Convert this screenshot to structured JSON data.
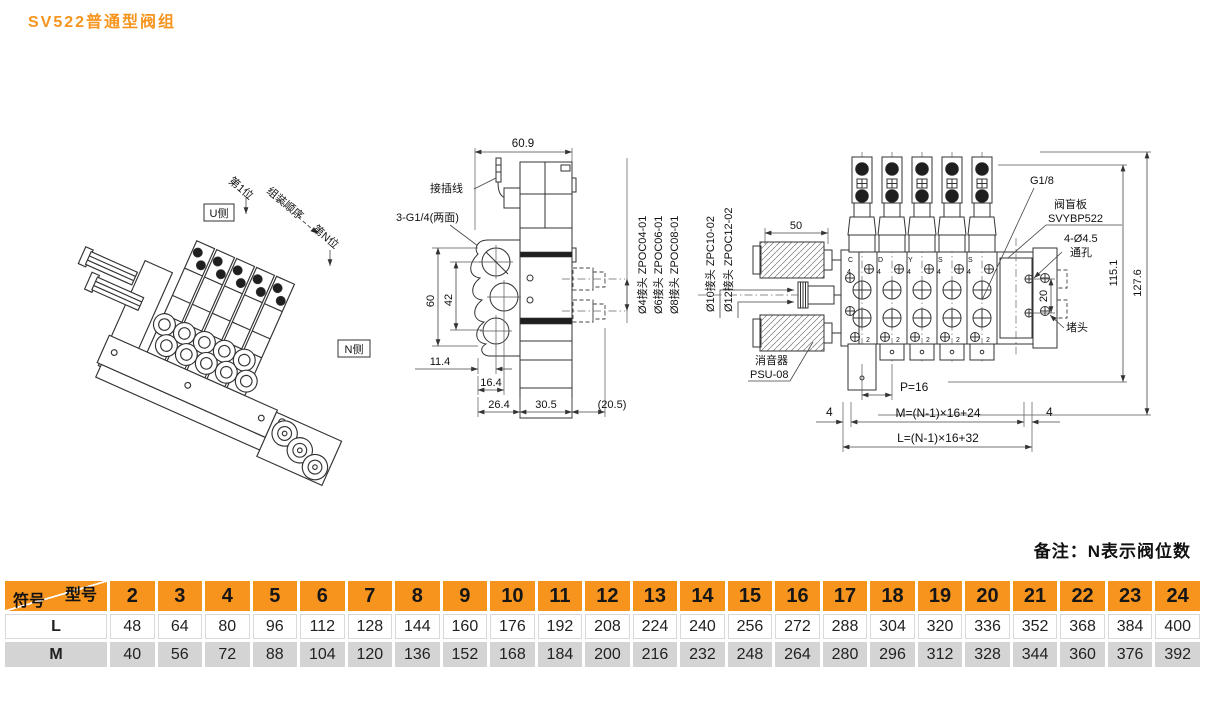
{
  "page": {
    "title": "SV522普通型阀组",
    "note": "备注：N表示阀位数"
  },
  "iso": {
    "pos_first": "第1位",
    "u_side": "U侧",
    "order": "组装顺序",
    "pos_n": "第N位",
    "n_side": "N侧"
  },
  "side": {
    "dim_width": "60.9",
    "wire": "接插线",
    "thread": "3-G1/4(两面)",
    "dim_h1": "60",
    "dim_h2": "42",
    "dim_b1": "11.4",
    "dim_b2": "16.4",
    "dim_b3": "26.4",
    "dim_b4": "30.5",
    "dim_b5": "(20.5)",
    "fit4": "Ø4接头 ZPOC04-01",
    "fit6": "Ø6接头 ZPOC06-01",
    "fit8": "Ø8接头 ZPOC08-01"
  },
  "top": {
    "fit10": "Ø10接头 ZPC10-02",
    "fit12": "Ø12接头 ZPOC12-02",
    "dim_muffler": "50",
    "port_size": "G1/8",
    "blank1": "阀盲板",
    "blank2": "SVYBP522",
    "hole1": "4-Ø4.5",
    "hole2": "通孔",
    "dim_hole": "20",
    "dim_h1": "115.1",
    "dim_h2": "127.6",
    "plug": "堵头",
    "muffler1": "消音器",
    "muffler2": "PSU-08",
    "pitch": "P=16",
    "m_formula": "M=(N-1)×16+24",
    "l_formula": "L=(N-1)×16+32",
    "edge4_left": "4",
    "edge4_right": "4",
    "mark4": "4",
    "mark2": "2",
    "station_letters": [
      "C",
      "D",
      "Y",
      "S",
      "S"
    ]
  },
  "table": {
    "corner_top": "型号",
    "corner_left": "符号",
    "models": [
      "2",
      "3",
      "4",
      "5",
      "6",
      "7",
      "8",
      "9",
      "10",
      "11",
      "12",
      "13",
      "14",
      "15",
      "16",
      "17",
      "18",
      "19",
      "20",
      "21",
      "22",
      "23",
      "24"
    ],
    "rows": [
      {
        "label": "L",
        "values": [
          "48",
          "64",
          "80",
          "96",
          "112",
          "128",
          "144",
          "160",
          "176",
          "192",
          "208",
          "224",
          "240",
          "256",
          "272",
          "288",
          "304",
          "320",
          "336",
          "352",
          "368",
          "384",
          "400"
        ]
      },
      {
        "label": "M",
        "values": [
          "40",
          "56",
          "72",
          "88",
          "104",
          "120",
          "136",
          "152",
          "168",
          "184",
          "200",
          "216",
          "232",
          "248",
          "264",
          "280",
          "296",
          "312",
          "328",
          "344",
          "360",
          "376",
          "392"
        ]
      }
    ]
  },
  "colors": {
    "accent": "#F7941E",
    "row_gray": "#D4D4D4"
  }
}
